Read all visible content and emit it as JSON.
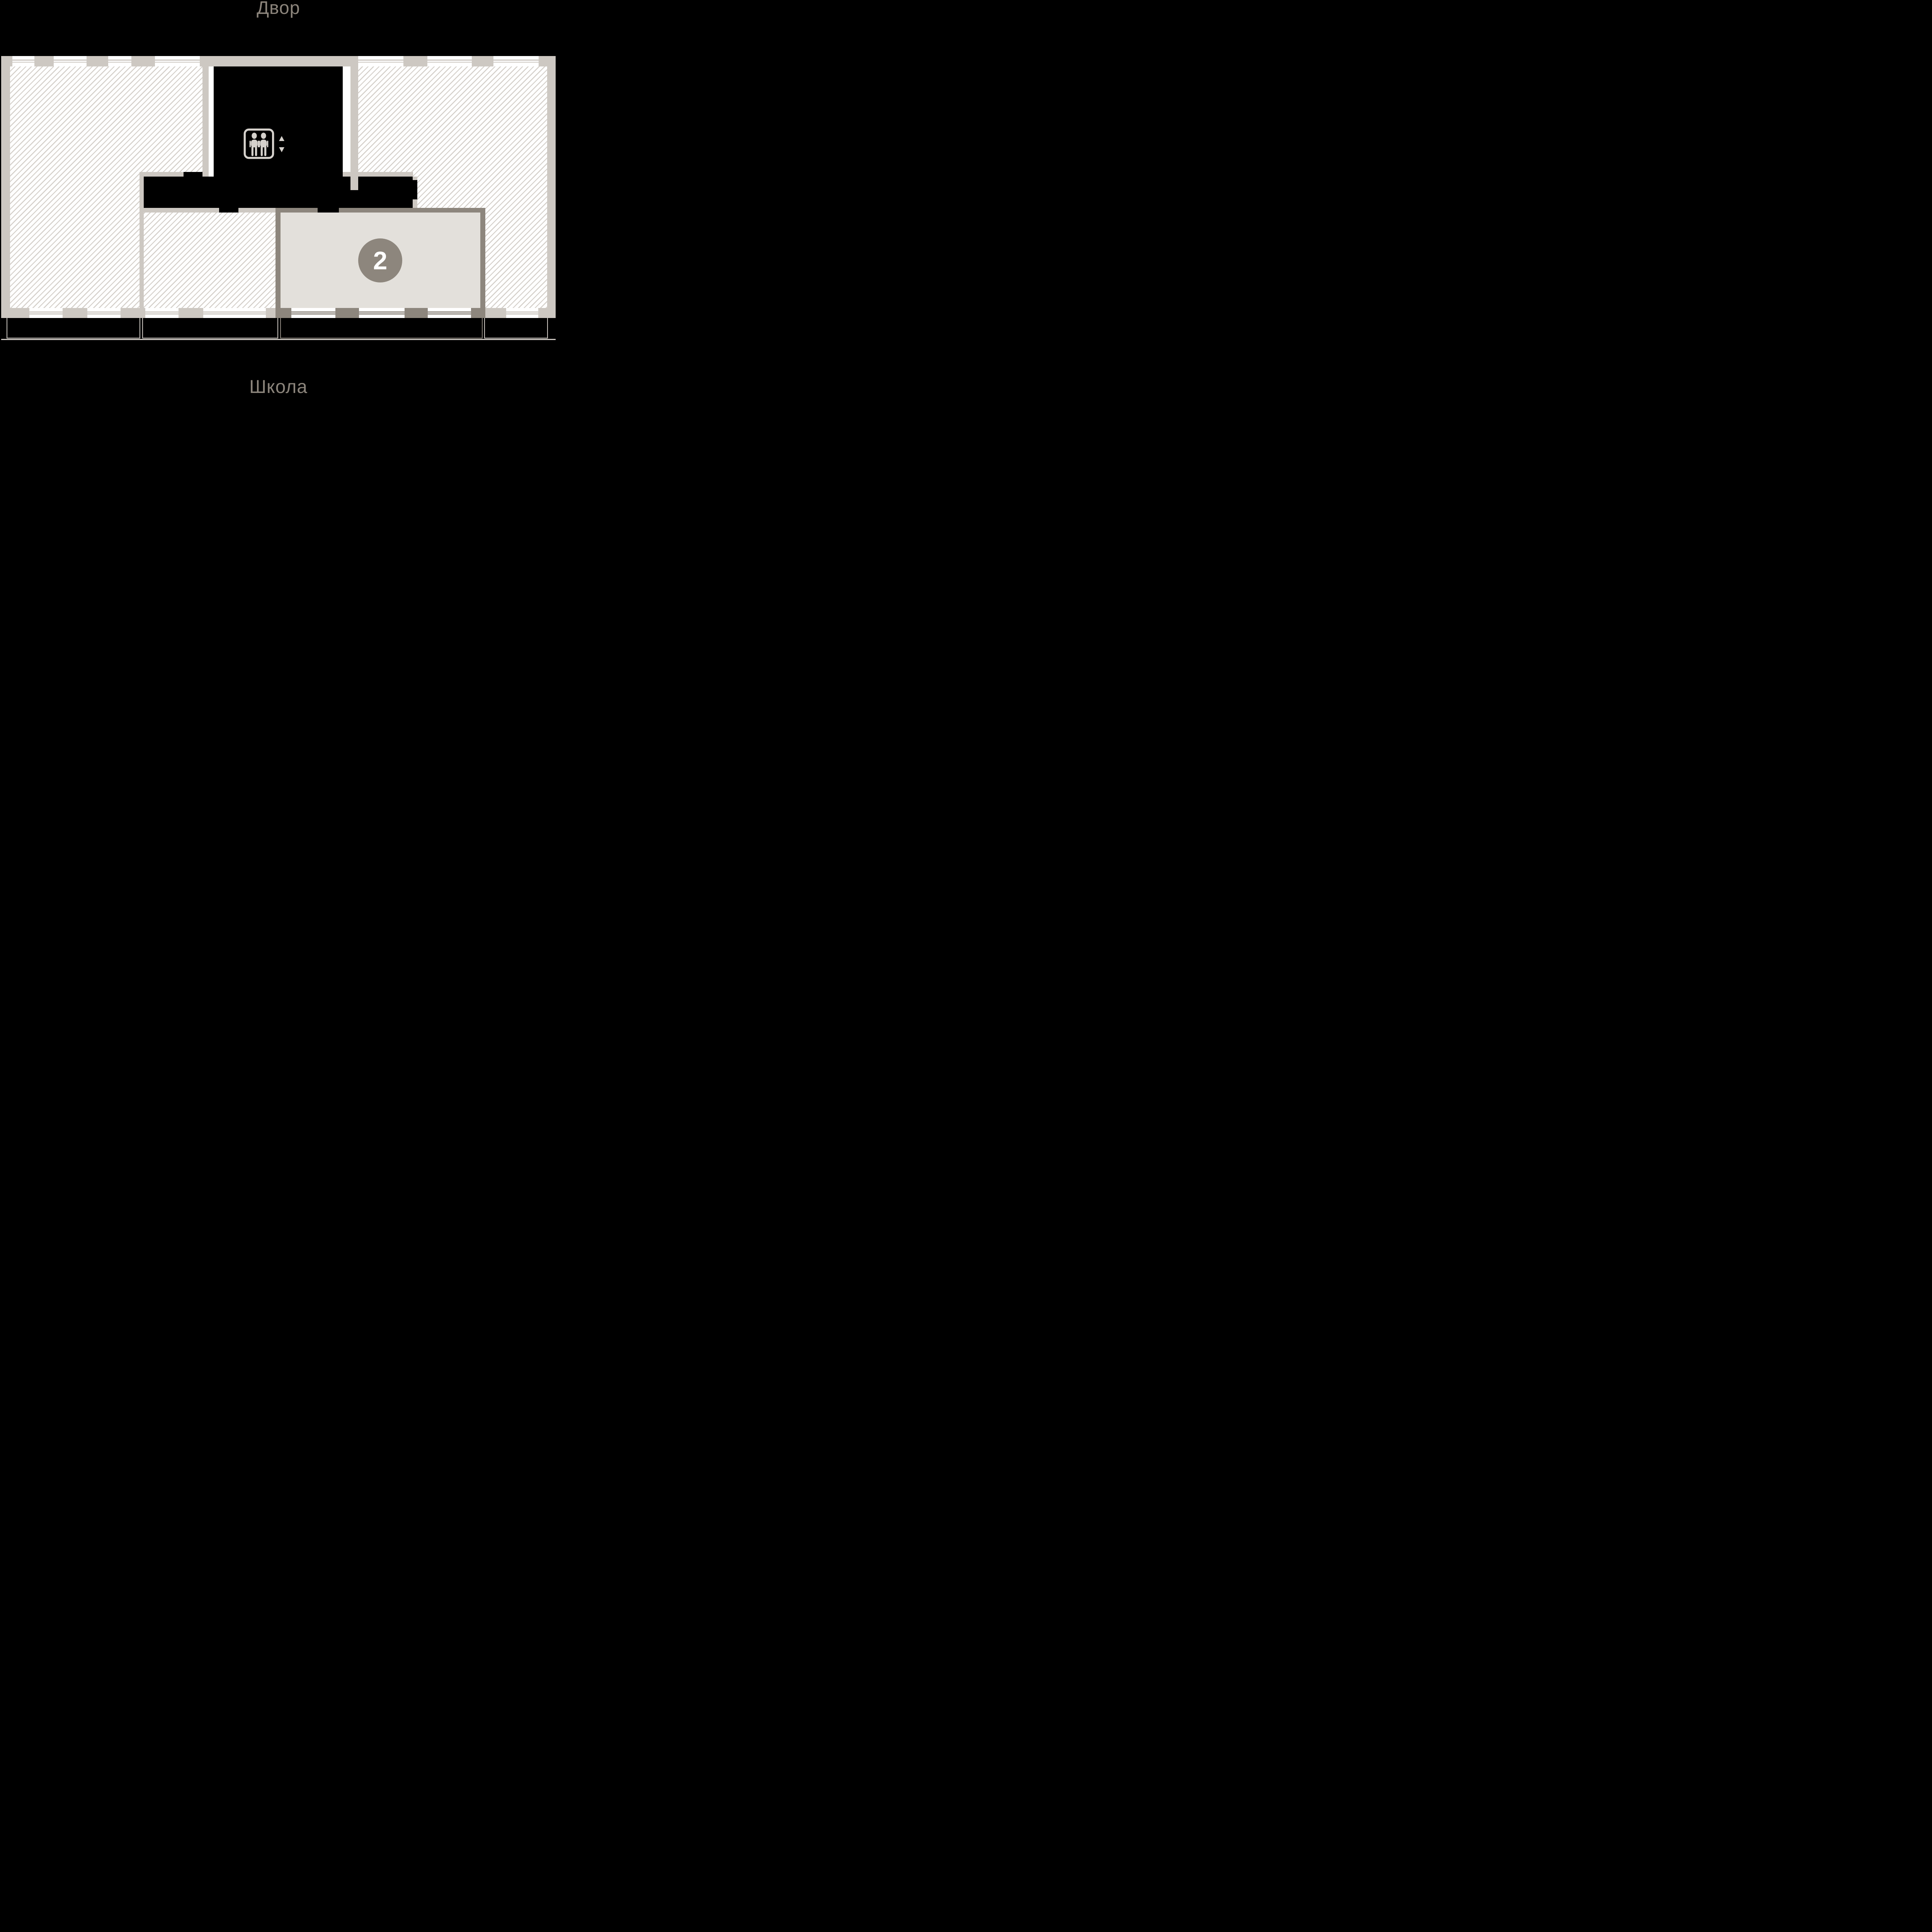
{
  "labels": {
    "top": "Двор",
    "bottom": "Школа"
  },
  "unit": {
    "number": "2"
  },
  "icons": {
    "elevator": "elevator-people-icon",
    "arrow_up": "arrow-up-icon",
    "arrow_down": "arrow-down-icon"
  },
  "colors": {
    "background": "#000000",
    "wall_light": "#cdc8c2",
    "wall_dark": "#8d867d",
    "hatch_line": "#d3cec8",
    "floor_white": "#ffffff",
    "unit_highlight_bg": "#e3e0db",
    "unit_badge_bg": "#8d867d",
    "unit_badge_text": "#ffffff",
    "label_text": "#8b847b",
    "icon_gray": "#d5d1cc"
  }
}
